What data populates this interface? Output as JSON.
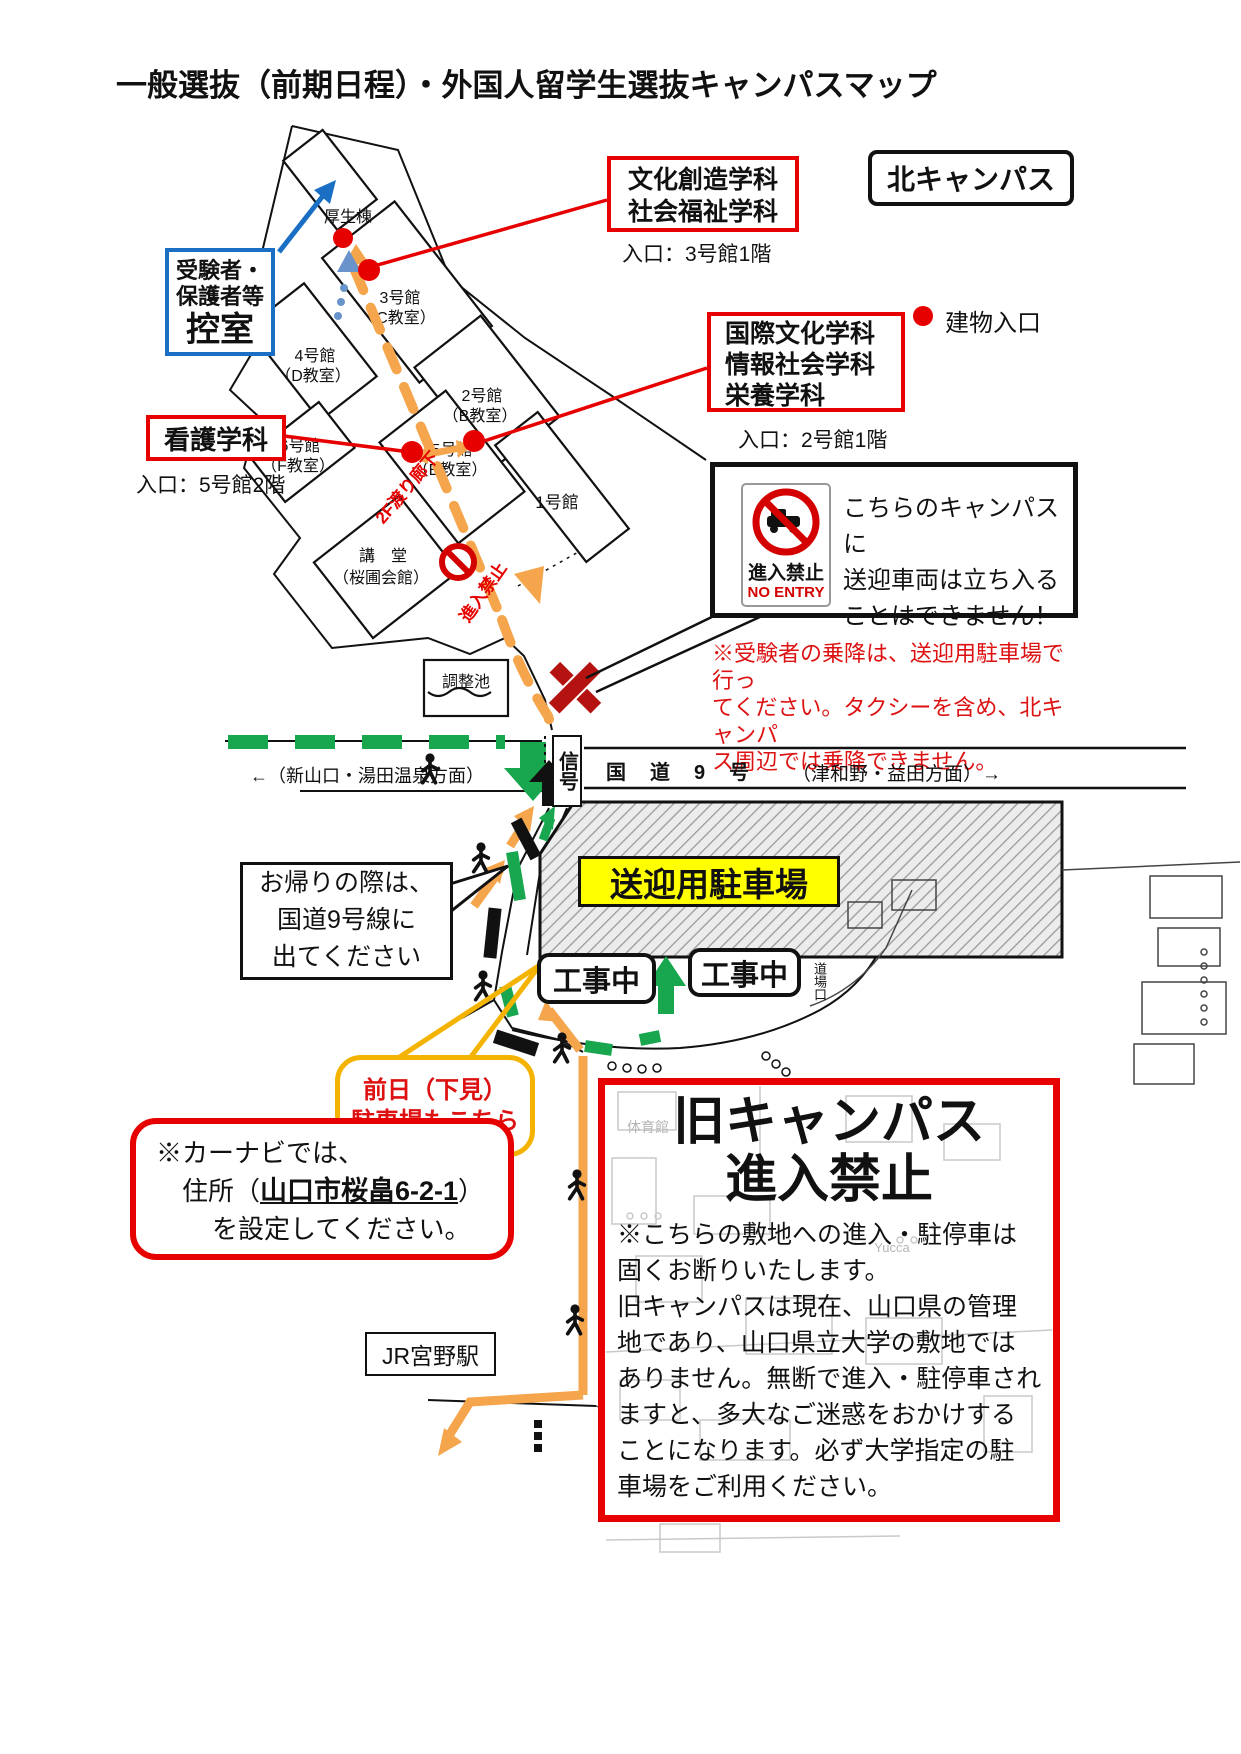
{
  "title": "一般選抜（前期日程）・外国人留学生選抜キャンパスマップ",
  "campus_tag": "北キャンパス",
  "legend": {
    "building_entrance": "建物入口"
  },
  "waiting_room": {
    "line1": "受験者・",
    "line2": "保護者等",
    "line3": "控室"
  },
  "departments": {
    "bunka": {
      "line1": "文化創造学科",
      "line2": "社会福祉学科",
      "entrance": "入口：3号館1階"
    },
    "kokusai": {
      "line1": "国際文化学科",
      "line2": "情報社会学科",
      "line3": "栄養学科",
      "entrance": "入口：2号館1階"
    },
    "kango": {
      "label": "看護学科",
      "entrance": "入口：5号館2階"
    }
  },
  "buildings": {
    "kosei": "厚生棟",
    "no3a": "3号館",
    "no3b": "（C教室）",
    "no4a": "4号館",
    "no4b": "（D教室）",
    "no2a": "2号館",
    "no2b": "（B教室）",
    "no6a": "6号館",
    "no6b": "（F教室）",
    "no5a": "5号館",
    "no5b": "（E教室）",
    "no1": "1号館",
    "kodoa": "講　堂",
    "kodob": "（桜圃会館）",
    "pond": "調整池"
  },
  "map_notes": {
    "corridor": "2F渡り廊下",
    "no_entry_path": "進入禁止",
    "dojo": "道場口"
  },
  "no_entry_box": {
    "sign_top": "進入禁止",
    "sign_bottom": "NO ENTRY",
    "text": "こちらのキャンパスに\n送迎車両は立ち入る\nことはできません！"
  },
  "ride_note": "※受験者の乗降は、送迎用駐車場で行っ\nてください。タクシーを含め、北キャンパ\nス周辺では乗降できません。",
  "road": {
    "left_dir": "←（新山口・湯田温泉方面）",
    "name": "国　道　9　号",
    "right_dir": "（津和野・益田方面）→",
    "signal": "信号"
  },
  "parking_label": "送迎用駐車場",
  "return_note": "お帰りの際は、\n国道9号線に\n出てください",
  "construction": "工事中",
  "previous_day": {
    "line1": "前日（下見）",
    "line2": "駐車場もこちら"
  },
  "old_campus": {
    "title1": "旧キャンパス",
    "title2": "進入禁止",
    "body": "※こちらの敷地への進入・駐停車は\n固くお断りいたします。\n旧キャンパスは現在、山口県の管理\n地であり、山口県立大学の敷地では\nありません。無断で進入・駐停車され\nますと、多大なご迷惑をおかけする\nことになります。必ず大学指定の駐\n車場をご利用ください。",
    "bg1": "体育館",
    "bg2": "Yucca"
  },
  "carnav": {
    "line1": "※カーナビでは、",
    "line2_pre": "住所（",
    "line2_addr": "山口市桜畠6-2-1",
    "line2_post": "）",
    "line3": "を設定してください。"
  },
  "station": "JR宮野駅",
  "colors": {
    "red": "#e60000",
    "blue": "#1a6fc4",
    "green": "#18a74f",
    "orange": "#f5a54c",
    "yellow": "#ffff00",
    "yellow_border": "#f5b301",
    "dark_red": "#b51212",
    "prohibit_red": "#d40000"
  }
}
